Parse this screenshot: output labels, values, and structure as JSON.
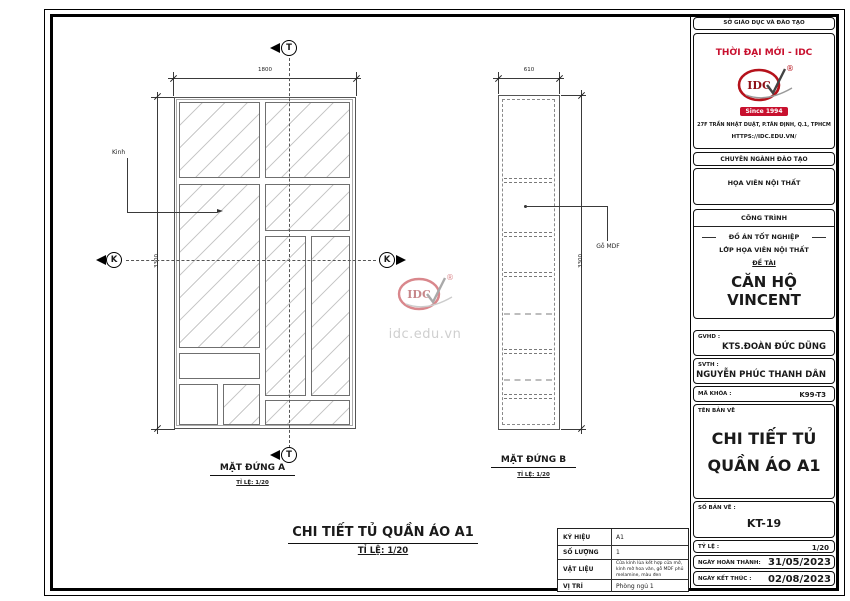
{
  "drawing": {
    "elevation_a": {
      "title": "MẶT ĐỨNG A",
      "scale": "TỈ LỆ: 1/20",
      "width_dim": "1800",
      "height_dim": "3300",
      "glass_label": "Kinh",
      "section_marker_vertical": "T",
      "section_marker_horizontal": "K"
    },
    "elevation_b": {
      "title": "MẶT ĐỨNG B",
      "scale": "TỈ LỆ: 1/20",
      "width_dim": "610",
      "height_dim": "3300",
      "mdf_label": "Gỗ MDF"
    },
    "sheet_title": "CHI TIẾT TỦ QUẦN ÁO A1",
    "sheet_scale": "TỈ LỆ: 1/20",
    "watermark": {
      "logo_text": "IDC",
      "registered": "®",
      "url": "idc.edu.vn"
    },
    "spec_table": {
      "rows": [
        {
          "label": "KÝ HIỆU",
          "value": "A1"
        },
        {
          "label": "SỐ LƯỢNG",
          "value": "1"
        },
        {
          "label": "VẬT LIỆU",
          "value": "Cửa kính lùa kết hợp cửa mở, kính mờ hoa văn, gỗ MDF phủ melamine, màu đen"
        },
        {
          "label": "VỊ TRÍ",
          "value": "Phòng ngủ 1"
        }
      ]
    }
  },
  "title_block": {
    "department": "SỞ GIÁO DỤC VÀ ĐÀO TẠO",
    "brand": "THỜI ĐẠI MỚI - IDC",
    "logo_text": "IDC",
    "registered": "®",
    "since": "Since 1994",
    "address": "27F TRẦN NHẬT DUẬT, P.TÂN ĐỊNH, Q.1, TPHCM",
    "website": "HTTPS://IDC.EDU.VN/",
    "training_header": "CHUYÊN NGÀNH ĐÀO TẠO",
    "training_major": "HỌA VIÊN NỘI THẤT",
    "project_header": "CÔNG TRÌNH",
    "project_type": "ĐỒ ÁN TỐT NGHIỆP",
    "project_class": "LỚP HỌA VIÊN NỘI THẤT",
    "topic_label": "ĐỀ TÀI",
    "topic_name": "CĂN HỘ VINCENT",
    "advisor_label": "GVHD :",
    "advisor_name": "KTS.ĐOÀN ĐỨC DŨNG",
    "student_label": "SVTH :",
    "student_name": "NGUYỄN PHÚC THANH DÂN",
    "class_code_label": "MÃ KHÓA :",
    "class_code": "K99-T3",
    "drawing_name_label": "TÊN BẢN VẼ",
    "drawing_name_line1": "CHI TIẾT TỦ",
    "drawing_name_line2": "QUẦN ÁO A1",
    "sheet_number_label": "SỐ BẢN VẼ :",
    "sheet_number": "KT-19",
    "scale_label": "TỶ LỆ :",
    "scale_value": "1/20",
    "date_completed_label": "NGÀY HOÀN THÀNH:",
    "date_completed": "31/05/2023",
    "date_end_label": "NGÀY KẾT THÚC :",
    "date_end": "02/08/2023"
  },
  "colors": {
    "accent_red": "#c8102e",
    "line_dark": "#1a1a1a",
    "hatch_gray": "#c9c9c9"
  }
}
